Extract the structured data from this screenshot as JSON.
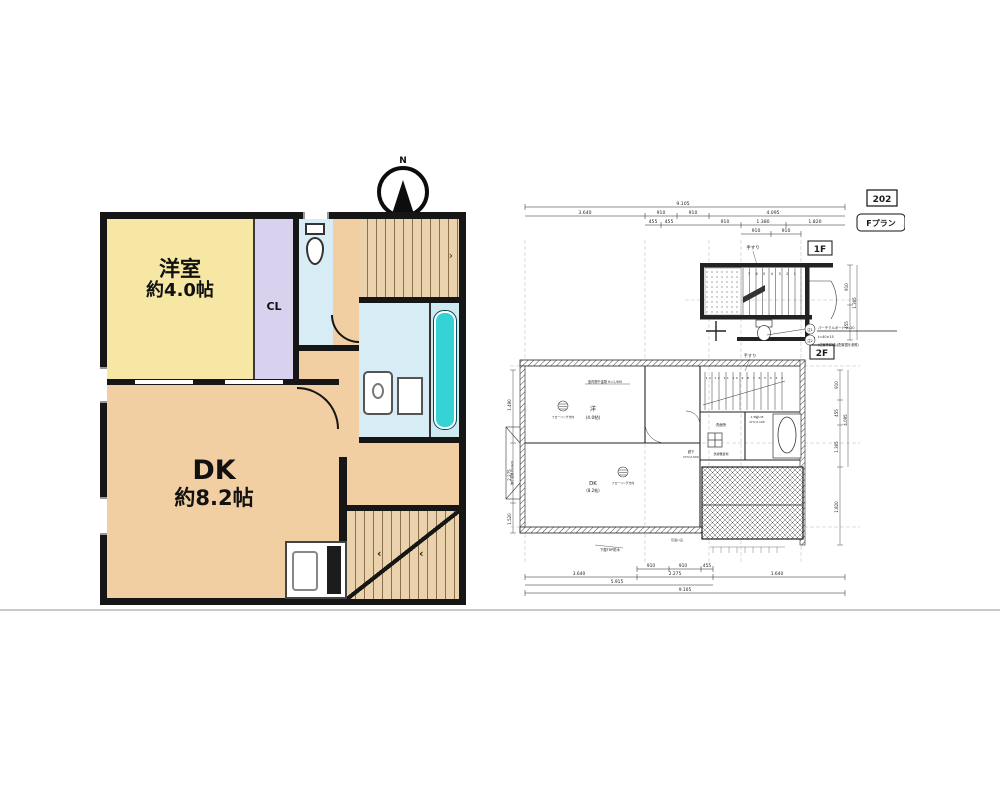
{
  "compass": {
    "label": "N"
  },
  "plan_left": {
    "room_west": {
      "name": "洋室",
      "area": "約4.0帖"
    },
    "closet_label": "CL",
    "dk": {
      "name": "DK",
      "area": "約8.2帖"
    },
    "colors": {
      "room_west": "#f6e7a5",
      "closet": "#d9d2ee",
      "floor": "#f2cfa2",
      "wet_rooms": "#d8ecf5",
      "stairs": "#ead2ac",
      "tub": "#35d2d6",
      "wall": "#161616"
    }
  },
  "cad": {
    "sheet_no": "202",
    "plan_name": "Fプラン",
    "floor_1f": "1F",
    "floor_2f": "2F",
    "labels": {
      "handrail_1f": "手すり",
      "handrail_2f": "手すり",
      "room_west": "洋",
      "room_west_area": "(4.0帖)",
      "dk": "DK",
      "dk_area": "(8.2帖)",
      "flooring_1": "フローリング方向",
      "flooring_2": "フローリング方向",
      "indoor_drying": "室内物干金物 H=1,900",
      "washroom": "洗面所",
      "washer": "洗濯機置場",
      "ub": "1.5帖U.B",
      "ub_ch": "CH=2,100",
      "hall": "廊下",
      "hall_ch": "CH=2,500",
      "waterproof": "下屋FRP防水",
      "window": "引違い窓",
      "drying_side": "物干金物 H=920",
      "note_ref1": "注1",
      "note_ref2": "注2",
      "note_line1": "パーチクルボード t=20",
      "note_line2": "t=40×15",
      "note_line3": "(位置等詳細は配置図を参照)"
    },
    "stairs": {
      "numbers_1f": "7 6 5 4 3 2 1",
      "numbers_2f": "13 12 11 10 9 8 7 6 5 4 3 2"
    },
    "dims_top": [
      "9.105",
      "3.640",
      "910",
      "910",
      "4.095",
      "455",
      "455",
      "910",
      "1.380",
      "1.820",
      "910",
      "910"
    ],
    "dims_bottom": [
      "910",
      "910",
      "455",
      "3.640",
      "2.275",
      "1.640",
      "5.915",
      "9.105"
    ],
    "dims_right_1f": [
      "910",
      "455",
      "1.365"
    ],
    "dims_right_2f": [
      "910",
      "455",
      "1.365",
      "4.095",
      "1.820"
    ],
    "dims_left": [
      "1.490",
      "2.275",
      "1.520"
    ]
  }
}
